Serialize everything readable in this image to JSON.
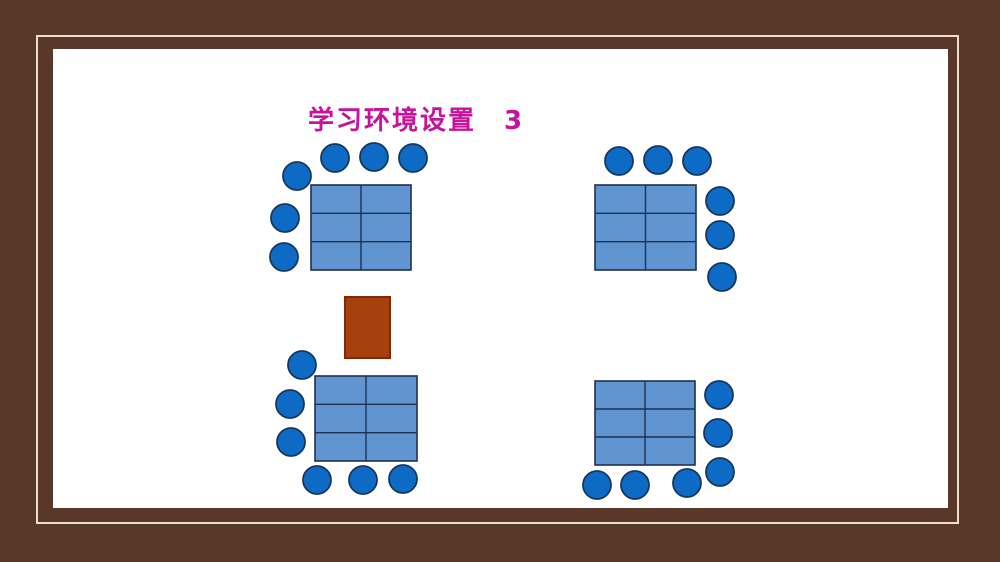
{
  "slide": {
    "title": "学习环境设置　3",
    "title_color": "#C9129B",
    "background_color": "#FFFFFF",
    "frame_color": "#5A3829",
    "frame_line_color": "#EFE0CE"
  },
  "colors": {
    "table_fill": "#6095D1",
    "table_border": "#1F3050",
    "seat_fill": "#0E6BC5",
    "seat_border": "#17375E",
    "desk_fill": "#A6400F",
    "desk_border": "#7A2B08"
  },
  "diagram": {
    "seat_radius": 14,
    "tables": [
      {
        "id": "top-left",
        "x": 311,
        "y": 185,
        "w": 100,
        "h": 85,
        "cols": 2,
        "rows": 3
      },
      {
        "id": "top-right",
        "x": 595,
        "y": 185,
        "w": 101,
        "h": 85,
        "cols": 2,
        "rows": 3
      },
      {
        "id": "bottom-left",
        "x": 315,
        "y": 376,
        "w": 102,
        "h": 85,
        "cols": 2,
        "rows": 3
      },
      {
        "id": "bottom-right",
        "x": 595,
        "y": 381,
        "w": 100,
        "h": 84,
        "cols": 2,
        "rows": 3
      }
    ],
    "seat_groups": [
      {
        "table": "top-left",
        "seats": [
          [
            335,
            158
          ],
          [
            374,
            157
          ],
          [
            413,
            158
          ],
          [
            297,
            176
          ],
          [
            285,
            218
          ],
          [
            284,
            257
          ]
        ]
      },
      {
        "table": "top-right",
        "seats": [
          [
            619,
            161
          ],
          [
            658,
            160
          ],
          [
            697,
            161
          ],
          [
            720,
            201
          ],
          [
            720,
            235
          ],
          [
            722,
            277
          ]
        ]
      },
      {
        "table": "bottom-left",
        "seats": [
          [
            302,
            365
          ],
          [
            290,
            404
          ],
          [
            291,
            442
          ],
          [
            317,
            480
          ],
          [
            363,
            480
          ],
          [
            403,
            479
          ]
        ]
      },
      {
        "table": "bottom-right",
        "seats": [
          [
            719,
            395
          ],
          [
            718,
            433
          ],
          [
            720,
            472
          ],
          [
            597,
            485
          ],
          [
            635,
            485
          ],
          [
            687,
            483
          ]
        ]
      }
    ],
    "teacher_desk": {
      "x": 345,
      "y": 297,
      "w": 45,
      "h": 61
    }
  }
}
